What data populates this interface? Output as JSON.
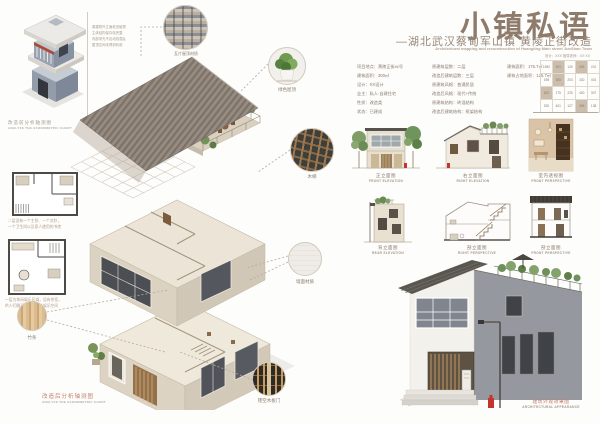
{
  "palette": {
    "title_brown": "#8f7b6c",
    "caption_red": "#c47c6e",
    "roof_gray": "#8a8078",
    "wall_beige": "#d8cfc1",
    "old_building_blue": "#97a0ad",
    "hydrant_red": "#c3342b"
  },
  "header": {
    "title": "小镇私语",
    "subtitle": "—湖北武汉蔡甸军山镇 黄陵正街改造",
    "subtitle_en": "Architectural mapping and reconstruction of  Huangling Main street  JunShan Town",
    "credits": "设计：XXX    指导老师：XX·XX"
  },
  "info": {
    "col1": [
      "项目地点：黄陵正街xx号",
      "建筑面积：300㎡",
      "设计：XX设计",
      "业主：私人·自建住宅",
      "性质：改造类",
      "状态：已建成"
    ],
    "col2": [
      "原建筑层数：二层",
      "改造后建筑层数：三层",
      "原建筑风格：普通民居",
      "改造后风格：现代+传统",
      "原建筑结构：砖混结构",
      "改造后建筑结构：框架结构"
    ],
    "col3": [
      "建筑面积：175.7㎡",
      "建筑占地面积：125.7㎡"
    ],
    "grid": {
      "rows": [
        [
          "1950",
          "201",
          "130",
          "401",
          "201"
        ],
        [
          "198",
          "305",
          "203",
          "330",
          "401"
        ],
        [
          "302",
          "175",
          "225",
          "400",
          "307"
        ],
        [
          "205",
          "401",
          "127",
          "305",
          "138"
        ]
      ]
    }
  },
  "left": {
    "old_axon_notes": [
      "原建筑外立面老旧破损",
      "主体结构保存较完整",
      "内部采光不足动线混乱",
      "屋顶空间未得到利用"
    ],
    "old_axon_caption": {
      "zh": "改造前分析轴测图",
      "en": "ANALYZE THE AXONOMETRIC CHART"
    },
    "plan1_caption": [
      "二层设有一个主卧、一个次卧，",
      "一个卫生间以及家人使用的书房"
    ],
    "plan2_caption": [
      "一层为休闲娱乐区域，设有茶室，",
      "供人们聊天休息的公共娱乐空间"
    ],
    "wood_label": "竹条",
    "new_axon_caption": {
      "zh": "改造后分析轴测图",
      "en": "ANALYZE THE AXONOMETRIC CHART"
    }
  },
  "details": {
    "tiles_label": "瓦片屋顶材质",
    "plant_label": "绿色屋顶",
    "ladder_label": "木梯",
    "wall_label": "墙面材质",
    "lattice_label": "镂空木板门"
  },
  "drawings": [
    {
      "zh": "正立面图",
      "en": "FRONT ELEVATION"
    },
    {
      "zh": "右立面图",
      "en": "RIGHT ELEVATION"
    },
    {
      "zh": "室内透视图",
      "en": "FRONT PERSPECTIVE"
    },
    {
      "zh": "背立面图",
      "en": "REAR ELEVATION"
    },
    {
      "zh": "剖立面图",
      "en": "RIGHT PERSPECTIVE"
    },
    {
      "zh": "剖立面图",
      "en": "FRONT PERSPECTIVE"
    }
  ],
  "render_caption": {
    "zh": "建筑外观效果图",
    "en": "ARCHITECTURAL APPEARANCE"
  }
}
